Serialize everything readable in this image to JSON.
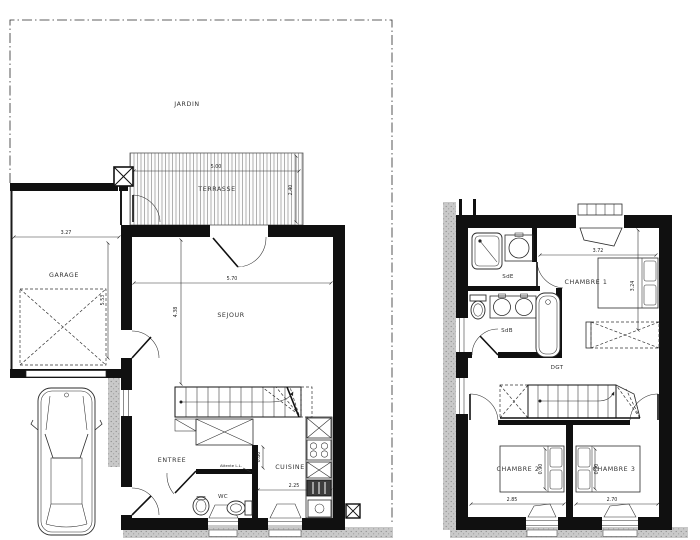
{
  "plan": {
    "ground": {
      "jardin": "JARDIN",
      "terrasse": "TERRASSE",
      "terrasse_w": "5.00",
      "terrasse_d": "2.40",
      "garage": "GARAGE",
      "garage_w": "3.27",
      "garage_d": "5.53",
      "sejour": "SEJOUR",
      "sejour_w": "5.70",
      "sejour_d": "4.38",
      "entree": "ENTREE",
      "wc": "WC",
      "wc_note": "Attente L.L.",
      "cuisine": "CUISINE",
      "cuisine_w": "2.25",
      "cuisine_d": "0.80"
    },
    "first": {
      "sde": "SdE",
      "sdb": "SdB",
      "dgt": "DGT",
      "ch1": "CHAMBRE 1",
      "ch1_w": "3.72",
      "ch1_d": "3.24",
      "ch2": "CHAMBRE 2",
      "ch2_w": "2.85",
      "ch2_bed": "0.90",
      "ch3": "CHAMBRE 3",
      "ch3_w": "2.70",
      "ch3_bed": "0.90"
    }
  }
}
